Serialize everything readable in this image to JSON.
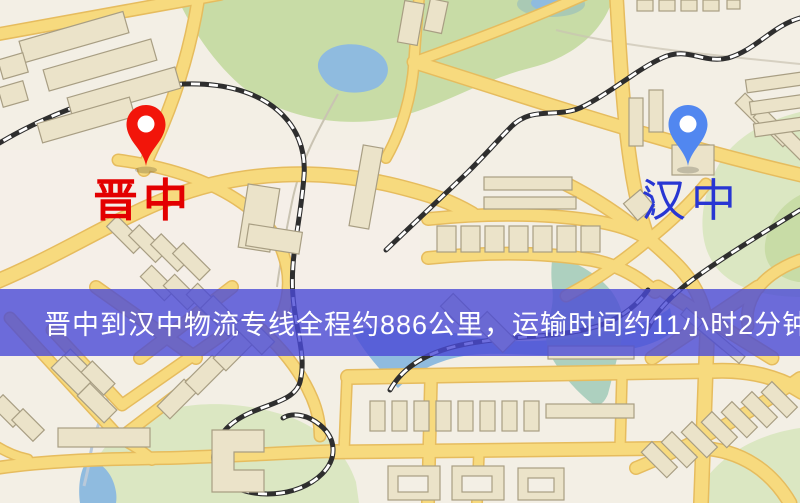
{
  "map": {
    "origin": {
      "name": "晋中",
      "label_color": "#e30000",
      "pin_color": "#f2150a"
    },
    "destination": {
      "name": "汉中",
      "label_color": "#2836d3",
      "pin_color": "#5187f0"
    },
    "banner": {
      "text": "晋中到汉中物流专线全程约886公里，运输时间约11小时2分钟.",
      "distance_km": "886",
      "duration": "11小时2分钟",
      "background_color": "#4a4ad6",
      "text_color": "#ffffff"
    },
    "palette": {
      "land": "#f3efe5",
      "park": "#c8dca6",
      "water": "#8fbbdf",
      "road_fill": "#f7da7e",
      "road_casing": "#e6bc5e",
      "building": "#ebe3c9",
      "railway": "#2e2e2e"
    }
  }
}
